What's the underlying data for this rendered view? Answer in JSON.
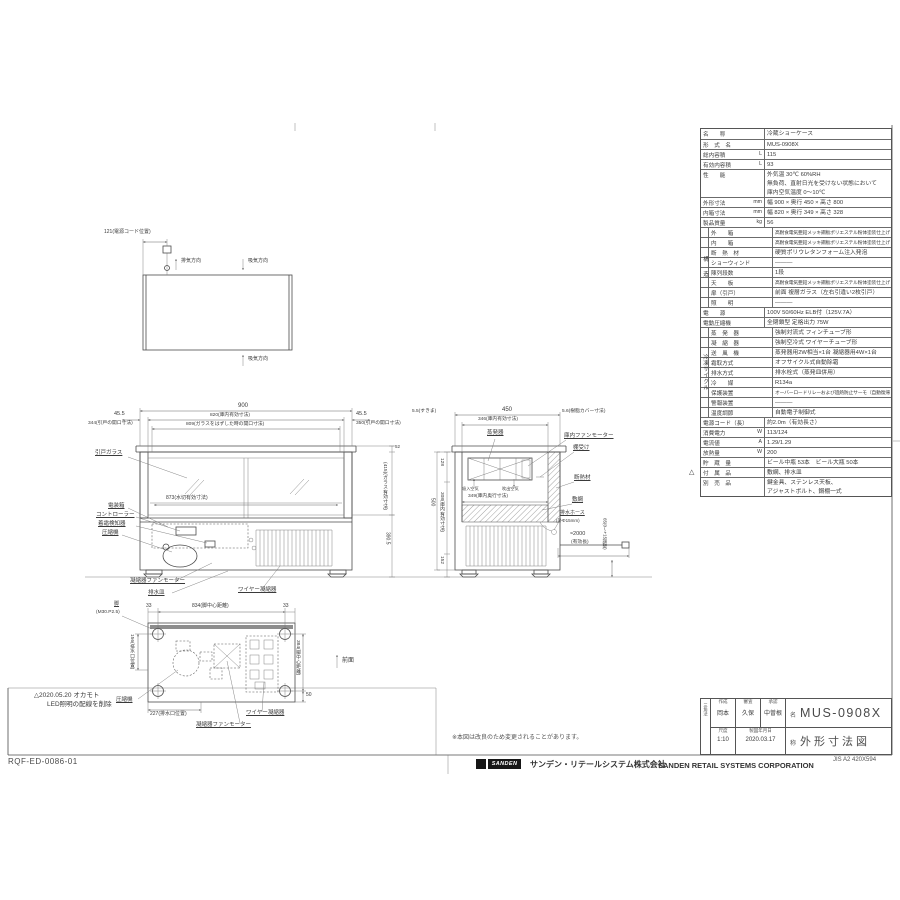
{
  "sheet": {
    "drawing_no": "RQF-ED-0086-01",
    "revision_note_line1": "△2020.05.20 オカモト",
    "revision_note_line2": "LED照明の配線を削除",
    "change_note": "※本図は改良のため変更されることがあります。",
    "rev_mark": "△",
    "logo_text": "SANDEN",
    "company_jp": "サンデン・リテールシステム株式会社",
    "company_en": "SANDEN RETAIL SYSTEMS CORPORATION",
    "paper_size": "JIS A2 420X594"
  },
  "spec_table": {
    "group1": "構　造",
    "group2": "冷凍サイクル",
    "rows": [
      {
        "label": "名　　称",
        "value": "冷蔵ショーケース"
      },
      {
        "label": "形　式　名",
        "value": "MUS-0908X"
      },
      {
        "label": "総内容積",
        "u": "L",
        "value": "115"
      },
      {
        "label": "有効内容積",
        "u": "L",
        "value": "93"
      },
      {
        "cls": "h3",
        "label": "性　　能",
        "value": "外気温 30℃ 60%RH\n無負荷、直射日光を受けない状態において\n庫内空気温度 0〜10℃"
      },
      {
        "label": "外形寸法",
        "u": "mm",
        "value": "幅 900 × 奥行 450 × 高さ 800"
      },
      {
        "label": "内箱寸法",
        "u": "mm",
        "value": "幅 820 × 奥行 349 × 高さ 328"
      },
      {
        "label": "製品質量",
        "u": "kg",
        "value": "56"
      },
      {
        "cls": "grp sv",
        "label": "外　　箱",
        "value": "高耐食電気亜鉛メッキ鋼板ポリエステル粉体塗装仕上げ"
      },
      {
        "cls": "grp sv",
        "label": "内　　箱",
        "value": "高耐食電気亜鉛メッキ鋼板ポリエステル粉体塗装仕上げ"
      },
      {
        "cls": "grp",
        "label": "断　熱　材",
        "value": "硬質ポリウレタンフォーム注入発泡"
      },
      {
        "cls": "grp",
        "label": "ショーウィンド",
        "value": "―――"
      },
      {
        "cls": "grp",
        "label": "陳列段数",
        "value": "1段"
      },
      {
        "cls": "grp sv",
        "label": "天　　板",
        "value": "高耐食電気亜鉛メッキ鋼板ポリエステル粉体塗装仕上げ"
      },
      {
        "cls": "grp",
        "label": "扉（引戸）",
        "value": "前面 複層ガラス（左右引違い2枚引戸）"
      },
      {
        "cls": "grp",
        "label": "照　　明",
        "value": "―――"
      },
      {
        "label": "電　　源",
        "value": "100V 50/60Hz ELB付（125V.7A）"
      },
      {
        "label": "電動圧縮機",
        "value": "全閉鎖型 定格出力 75W"
      },
      {
        "cls": "grp",
        "label": "蒸　発　器",
        "value": "強制対流式 フィンチューブ形"
      },
      {
        "cls": "grp",
        "label": "凝　縮　器",
        "value": "強制空冷式 ワイヤーチューブ形"
      },
      {
        "cls": "grp",
        "label": "送　風　機",
        "value": "蒸発器用2W相当×1台 凝縮器用4W×1台"
      },
      {
        "cls": "grp",
        "label": "霜取方式",
        "value": "オフサイクル式自動除霜"
      },
      {
        "cls": "grp",
        "label": "排水方式",
        "value": "排水栓式（蒸発皿併用）"
      },
      {
        "cls": "grp",
        "label": "冷　　媒",
        "value": "R134a"
      },
      {
        "cls": "grp sv",
        "label": "保護装置",
        "value": "オーバーロードリレーおよび過熱防止サーモ（自動復帰型）"
      },
      {
        "cls": "grp",
        "label": "警報装置",
        "value": "―――"
      },
      {
        "cls": "grp",
        "label": "温度調節",
        "value": "自動電子制御式"
      },
      {
        "label": "電源コード（長）",
        "value": "約2.0m（有効長さ）"
      },
      {
        "label": "消費電力",
        "u": "W",
        "value": "113/124"
      },
      {
        "label": "電流値",
        "u": "A",
        "value": "1.29/1.29"
      },
      {
        "label": "放熱量",
        "u": "W",
        "value": "200"
      },
      {
        "label": "貯　蔵　量",
        "value": "ビール中瓶 53本　ビール大瓶 50本"
      },
      {
        "label": "付　属　品",
        "value": "敷網、排水皿"
      },
      {
        "cls": "h2",
        "label": "別　売　品",
        "value": "鍵金具、ステンレス天板、\nアジャストボルト、鋼棚一式"
      }
    ]
  },
  "title_block": {
    "projection": "三角法",
    "created_label": "作成",
    "created": "岡本",
    "checked_label": "審査",
    "checked": "久保",
    "approved_label": "承認",
    "approved": "中曽根",
    "scale_label": "尺度",
    "scale": "1:10",
    "date_label": "製図年月日",
    "date": "2020.03.17",
    "name_label": "名",
    "name": "MUS-0908X",
    "title_label": "称",
    "title": "外形寸法図"
  },
  "top_view": {
    "cord_dim": "121(電源コード位置)",
    "exhaust": "排気方向",
    "intake_top": "吸気方向",
    "intake_bottom": "吸気方向"
  },
  "front_view": {
    "dim_width": "900",
    "dim_inner": "820(庫内有効寸法)",
    "dim_opening": "809(ガラスをはずした時の開口寸法)",
    "left_offset": "45.5",
    "left_open": "344(引戸の開口寸法)",
    "right_offset": "45.5",
    "right_open": "350(引戸の開口寸法)",
    "h_top": "52",
    "h_mid": "(415)(ガラス有効寸法)",
    "h_bot": "390.5",
    "glass": "引戸ガラス",
    "drip": "873(水切有効寸法)",
    "elec_box": "電装箱",
    "controller": "コントローラー",
    "frost": "着霜検知器",
    "compressor": "圧縮機",
    "cond_fan": "凝縮器ファンモーター",
    "drain_pan": "排水皿",
    "wire_cond": "ワイヤー凝縮器"
  },
  "side_view": {
    "gap_left": "5.5(すきま)",
    "dim_depth": "450",
    "cover": "5.6(樹脂カバー寸法)",
    "inner_top": "346(庫内有効寸法)",
    "evap": "蒸発器",
    "fan": "庫内ファンモーター",
    "shelf": "棚受け",
    "suction": "吸入空気",
    "blow": "吹出空気",
    "insul": "断熱材",
    "inner_depth": "349(庫内奥行寸法)",
    "mat": "敷網",
    "hose1": "排水ホース",
    "hose2": "(外Φ15mm)",
    "d128": "128",
    "d308": "308(庫内有効寸法)",
    "d500": "500",
    "d152": "152",
    "cord": "≈2000",
    "cord2": "(有効長)",
    "adj": "65(0〜+15調整)"
  },
  "bottom_view": {
    "d33l": "33",
    "d834": "834(脚中心距離)",
    "d33r": "33",
    "leg1": "脚",
    "leg2": "(M30.P2.5)",
    "d156": "156(排水口位置)",
    "d384": "384(脚中心距離)",
    "d50": "50",
    "d227": "227(排水口位置)",
    "comp": "圧縮機",
    "fan": "凝縮器ファンモーター",
    "wire": "ワイヤー凝縮器",
    "front_dir": "前面"
  }
}
